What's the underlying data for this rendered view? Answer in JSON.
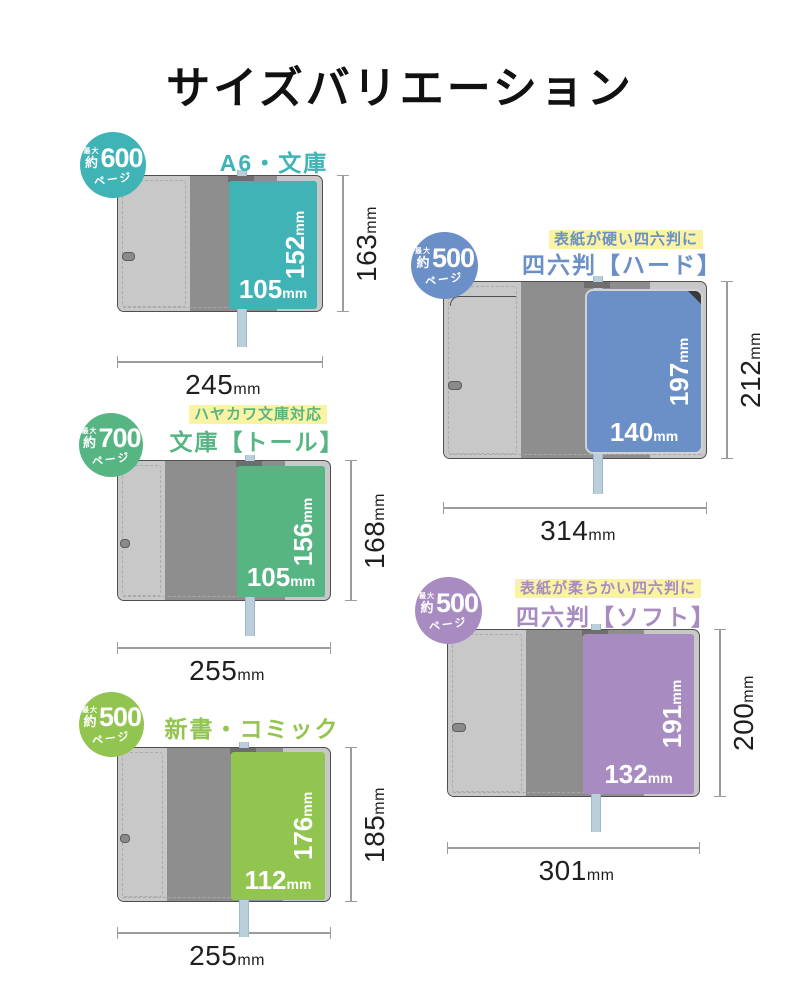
{
  "page": {
    "title": "サイズバリエーション"
  },
  "unit": "mm",
  "colors": {
    "background": "#ffffff",
    "title_text": "#111111",
    "cover_light": "#c8c8c8",
    "cover_dark": "#8e8e8e",
    "cover_outline": "#4f4f4f",
    "bookmark_ribbon": "#b9cfdc",
    "tagline_highlight": "#faf3a3",
    "dimension_line": "#9c9c9c",
    "dimension_text": "#1f1f1f"
  },
  "books": [
    {
      "title": "A6・文庫",
      "tagline": "",
      "accent": "#3fb3b5",
      "badge": {
        "max_label": "最大",
        "approx_label": "約",
        "pages": "600",
        "pages_label": "ページ"
      },
      "cover_width_mm": 245,
      "cover_height_mm": 163,
      "book_width_mm": 105,
      "book_height_mm": 152,
      "style": "soft"
    },
    {
      "title": "文庫【トール】",
      "tagline": "ハヤカワ文庫対応",
      "accent": "#57b584",
      "badge": {
        "max_label": "最大",
        "approx_label": "約",
        "pages": "700",
        "pages_label": "ページ"
      },
      "cover_width_mm": 255,
      "cover_height_mm": 168,
      "book_width_mm": 105,
      "book_height_mm": 156,
      "style": "soft"
    },
    {
      "title": "新書・コミック",
      "tagline": "",
      "accent": "#92c54f",
      "badge": {
        "max_label": "最大",
        "approx_label": "約",
        "pages": "500",
        "pages_label": "ページ"
      },
      "cover_width_mm": 255,
      "cover_height_mm": 185,
      "book_width_mm": 112,
      "book_height_mm": 176,
      "style": "soft"
    },
    {
      "title": "四六判【ハード】",
      "tagline": "表紙が硬い四六判に",
      "accent": "#6b8fc7",
      "badge": {
        "max_label": "最大",
        "approx_label": "約",
        "pages": "500",
        "pages_label": "ページ"
      },
      "cover_width_mm": 314,
      "cover_height_mm": 212,
      "book_width_mm": 140,
      "book_height_mm": 197,
      "style": "hard"
    },
    {
      "title": "四六判【ソフト】",
      "tagline": "表紙が柔らかい四六判に",
      "accent": "#a88cc1",
      "badge": {
        "max_label": "最大",
        "approx_label": "約",
        "pages": "500",
        "pages_label": "ページ"
      },
      "cover_width_mm": 301,
      "cover_height_mm": 200,
      "book_width_mm": 132,
      "book_height_mm": 191,
      "style": "soft"
    }
  ]
}
